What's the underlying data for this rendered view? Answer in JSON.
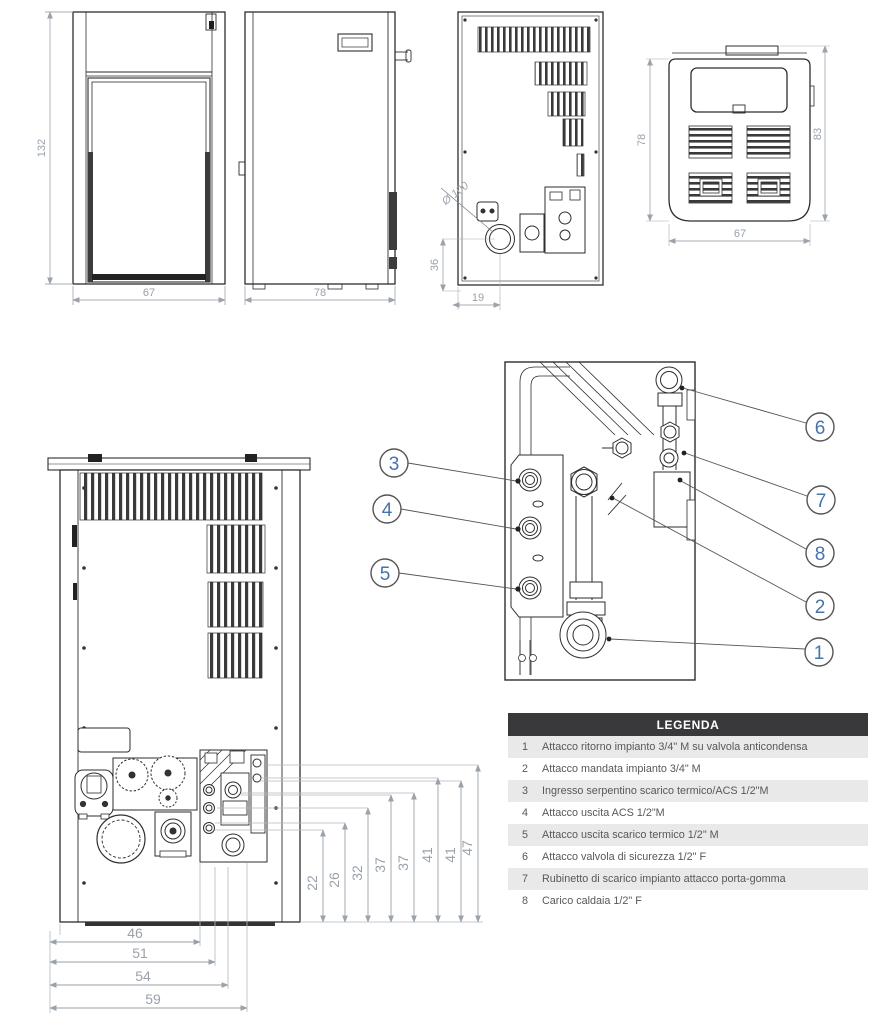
{
  "dims": {
    "front_height": "132",
    "front_width": "67",
    "side_depth": "78",
    "back_flue_diameter": "Ø 100",
    "back_flue_height": "36",
    "back_flue_offset": "19",
    "top_depth": "78",
    "top_total_depth": "83",
    "top_width": "67"
  },
  "detail": {
    "callouts_left": [
      "3",
      "4",
      "5"
    ],
    "callouts_right": [
      "6",
      "7",
      "8",
      "2",
      "1"
    ]
  },
  "rear": {
    "vertical_dims": [
      "22",
      "26",
      "32",
      "37",
      "37",
      "41",
      "41",
      "47"
    ],
    "horizontal_dims": [
      "46",
      "51",
      "54",
      "59"
    ]
  },
  "legend": {
    "title": "LEGENDA",
    "items": [
      {
        "num": "1",
        "text": "Attacco ritorno impianto 3/4\" M su valvola anticondensa"
      },
      {
        "num": "2",
        "text": "Attacco mandata impianto 3/4\" M"
      },
      {
        "num": "3",
        "text": "Ingresso serpentino scarico termico/ACS 1/2\"M"
      },
      {
        "num": "4",
        "text": "Attacco uscita ACS 1/2\"M"
      },
      {
        "num": "5",
        "text": "Attacco uscita scarico termico 1/2\" M"
      },
      {
        "num": "6",
        "text": "Attacco valvola di sicurezza 1/2\" F"
      },
      {
        "num": "7",
        "text": "Rubinetto di scarico impianto attacco porta-gomma"
      },
      {
        "num": "8",
        "text": "Carico caldaia 1/2\" F"
      }
    ]
  },
  "colors": {
    "line": "#2e2e2e",
    "dim": "#a0a7af",
    "callout_number": "#4673ad",
    "legend_header_bg": "#39393b",
    "legend_row_alt": "#e9e9ea",
    "legend_text": "#58585a"
  }
}
